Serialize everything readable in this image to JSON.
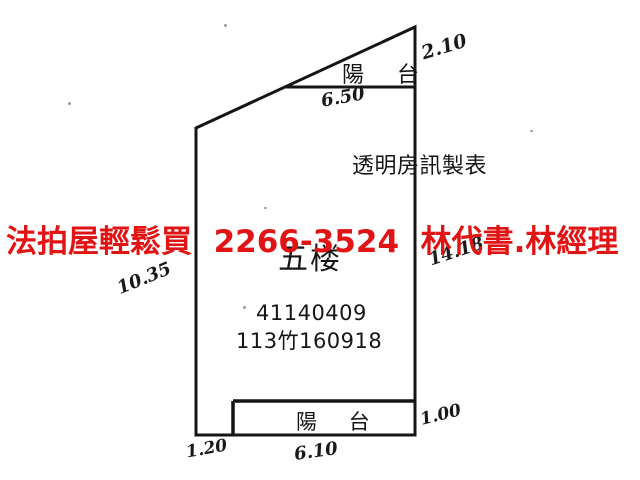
{
  "overlay_ad": {
    "text": "法拍屋輕鬆買  2266-3524  林代書.林經理",
    "color": "#e01414"
  },
  "plan": {
    "line_color": "#151515",
    "top_balcony_label": "陽    台",
    "bottom_balcony_label": "陽    台",
    "maker_label": "透明房訊製表",
    "floor_label": "五楼",
    "case_number_line1": "41140409",
    "case_number_line2": "113竹160918",
    "measurements": {
      "top_right": "2.10",
      "top_width": "6.50",
      "left_height": "10.35",
      "right_height": "14.18",
      "bottom_right": "1.00",
      "bottom_left": "1.20",
      "bottom_width": "6.10"
    }
  }
}
